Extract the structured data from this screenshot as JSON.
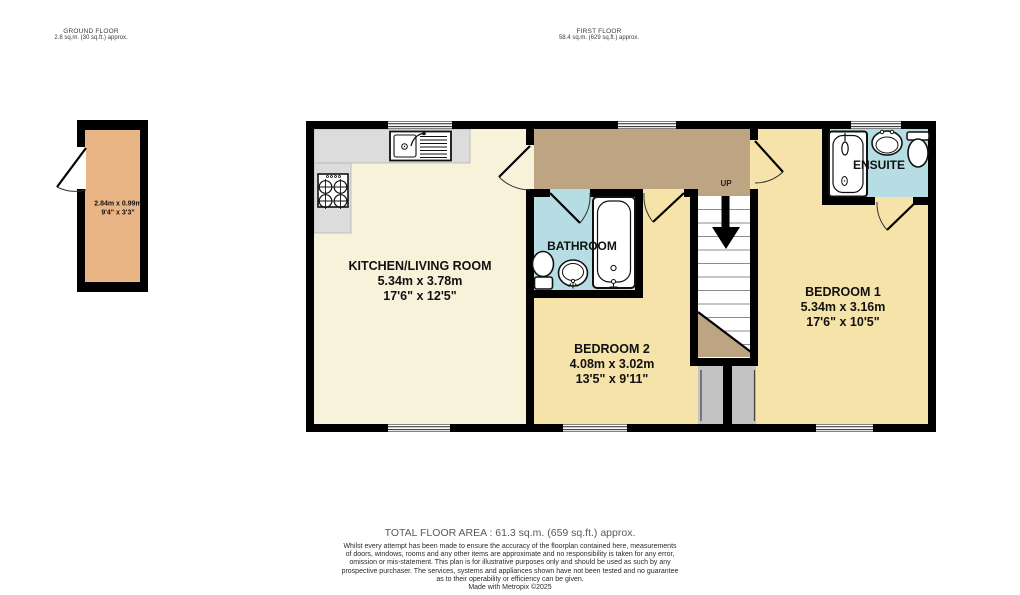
{
  "headers": {
    "ground_floor": {
      "title": "GROUND FLOOR",
      "area": "2.8 sq.m. (30 sq.ft.) approx."
    },
    "first_floor": {
      "title": "FIRST FLOOR",
      "area": "58.4 sq.m. (629 sq.ft.) approx."
    }
  },
  "rooms": {
    "store": {
      "dims_metric": "2.84m x 0.99m",
      "dims_imperial": "9'4\" x 3'3\""
    },
    "kitchen_living": {
      "name": "KITCHEN/LIVING ROOM",
      "dims_metric": "5.34m x 3.78m",
      "dims_imperial": "17'6\" x 12'5\""
    },
    "bathroom": {
      "name": "BATHROOM"
    },
    "bedroom2": {
      "name": "BEDROOM 2",
      "dims_metric": "4.08m x 3.02m",
      "dims_imperial": "13'5\" x 9'11\""
    },
    "bedroom1": {
      "name": "BEDROOM 1",
      "dims_metric": "5.34m x 3.16m",
      "dims_imperial": "17'6\" x 10'5\""
    },
    "ensuite": {
      "name": "ENSUITE"
    },
    "stairs": {
      "direction_label": "UP"
    }
  },
  "footer": {
    "total_area": "TOTAL FLOOR AREA : 61.3 sq.m. (659 sq.ft.) approx.",
    "disclaimer_lines": [
      "Whilst every attempt has been made to ensure the accuracy of the floorplan contained here, measurements",
      "of doors, windows, rooms and any other items are approximate and no responsibility is taken for any error,",
      "omission or mis-statement. This plan is for illustrative purposes only and should be used as such by any",
      "prospective purchaser. The services, systems and appliances shown have not been tested and no guarantee",
      "as to their operability or efficiency can be given."
    ],
    "credit": "Made with Metropix ©2025"
  },
  "colors": {
    "wall": "#000000",
    "bedroom_yellow": "#f5e3a9",
    "kitchen_cream": "#f8f2da",
    "landing_tan": "#bda584",
    "wet_room_blue": "#b6dce4",
    "store_orange": "#eab584",
    "counter_grey": "#dcdcdc",
    "understair_grey": "#c3c3c3"
  }
}
